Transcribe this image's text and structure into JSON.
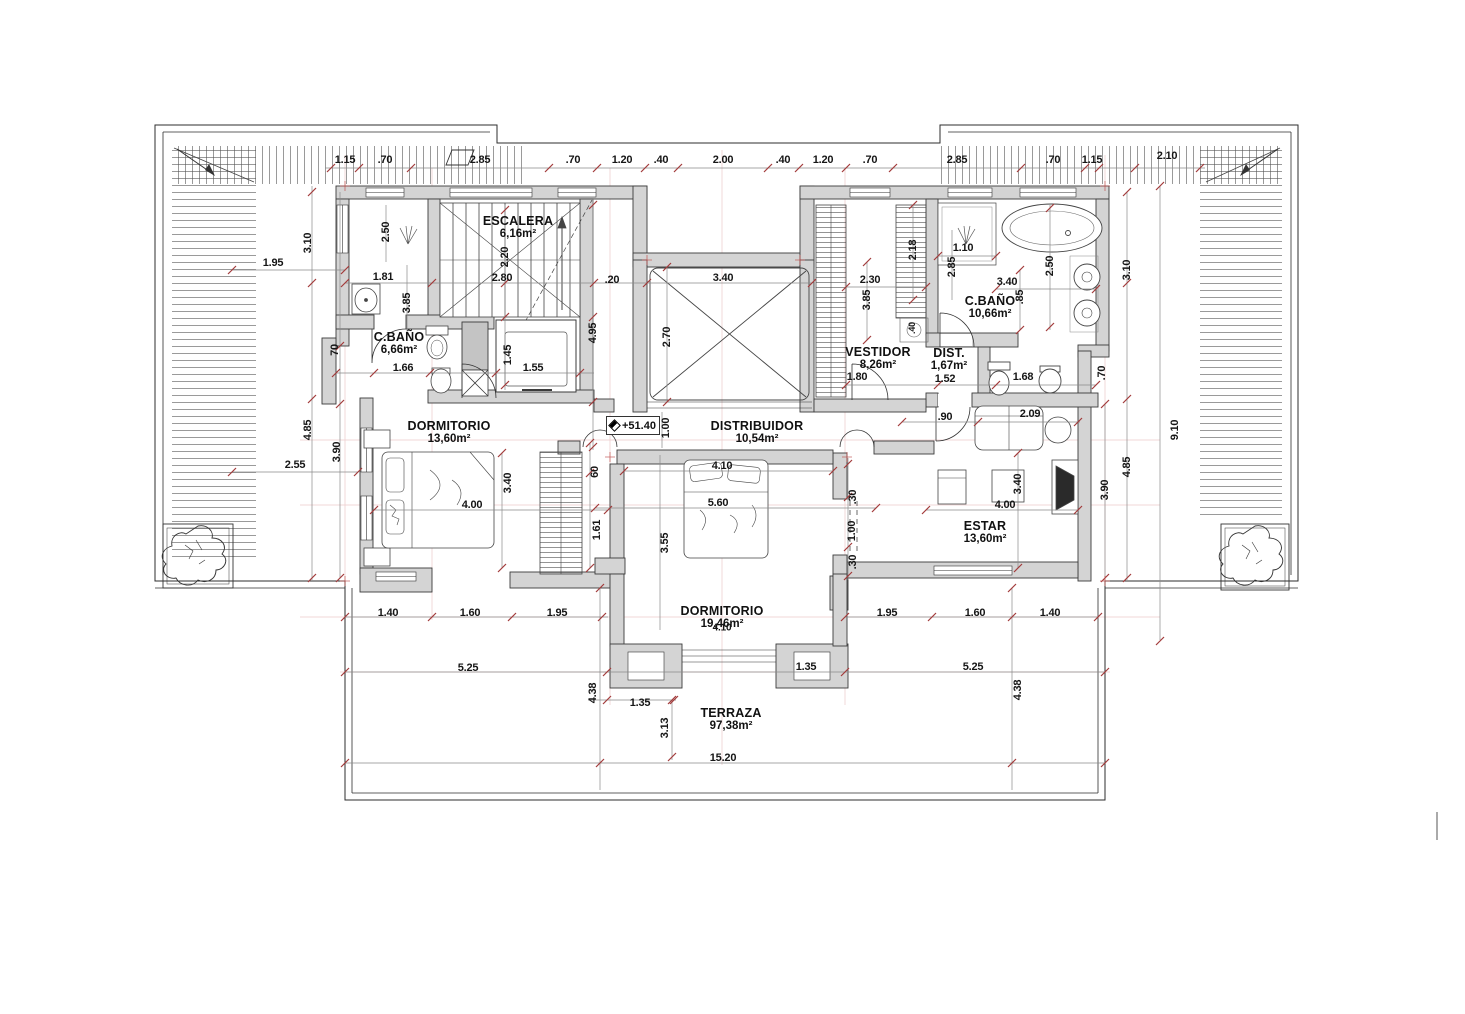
{
  "colors": {
    "wall_fill": "#d4d4d4",
    "wall_stroke": "#3b3b3b",
    "tick": "#a33b3b",
    "faint_line": "#e7bdbd"
  },
  "level": {
    "value": "+51.40"
  },
  "rooms": [
    {
      "name": "ESCALERA",
      "area": "6,16m²",
      "x": 518,
      "y": 228
    },
    {
      "name": "C.BAÑO",
      "area": "6,66m²",
      "x": 399,
      "y": 344
    },
    {
      "name": "DORMITORIO",
      "area": "13,60m²",
      "x": 449,
      "y": 433
    },
    {
      "name": "DISTRIBUIDOR",
      "area": "10,54m²",
      "x": 757,
      "y": 433
    },
    {
      "name": "DORMITORIO",
      "area": "19,46m²",
      "x": 722,
      "y": 618
    },
    {
      "name": "VESTIDOR",
      "area": "8,26m²",
      "x": 878,
      "y": 359
    },
    {
      "name": "DIST.",
      "area": "1,67m²",
      "x": 949,
      "y": 360
    },
    {
      "name": "C.BAÑO",
      "area": "10,66m²",
      "x": 990,
      "y": 308
    },
    {
      "name": "ESTAR",
      "area": "13,60m²",
      "x": 985,
      "y": 533
    },
    {
      "name": "TERRAZA",
      "area": "97,38m²",
      "x": 731,
      "y": 720
    }
  ],
  "dimensions": [
    {
      "t": "1.15",
      "x": 345,
      "y": 160
    },
    {
      "t": ".70",
      "x": 385,
      "y": 160
    },
    {
      "t": "2.85",
      "x": 480,
      "y": 160
    },
    {
      "t": ".70",
      "x": 573,
      "y": 160
    },
    {
      "t": "1.20",
      "x": 622,
      "y": 160
    },
    {
      "t": ".40",
      "x": 661,
      "y": 160
    },
    {
      "t": "2.00",
      "x": 723,
      "y": 160
    },
    {
      "t": ".40",
      "x": 783,
      "y": 160
    },
    {
      "t": "1.20",
      "x": 823,
      "y": 160
    },
    {
      "t": ".70",
      "x": 870,
      "y": 160
    },
    {
      "t": "2.85",
      "x": 957,
      "y": 160
    },
    {
      "t": ".70",
      "x": 1053,
      "y": 160
    },
    {
      "t": "1.15",
      "x": 1092,
      "y": 160
    },
    {
      "t": "2.10",
      "x": 1167,
      "y": 156
    },
    {
      "t": "1.95",
      "x": 273,
      "y": 263
    },
    {
      "t": "3.10",
      "x": 308,
      "y": 243,
      "r": 1
    },
    {
      "t": "2.50",
      "x": 386,
      "y": 232,
      "r": 1
    },
    {
      "t": "1.81",
      "x": 383,
      "y": 277
    },
    {
      "t": "3.85",
      "x": 407,
      "y": 303,
      "r": 1
    },
    {
      "t": "70",
      "x": 335,
      "y": 350,
      "r": 1
    },
    {
      "t": "4.85",
      "x": 308,
      "y": 430,
      "r": 1
    },
    {
      "t": "3.90",
      "x": 337,
      "y": 452,
      "r": 1
    },
    {
      "t": "2.55",
      "x": 295,
      "y": 465
    },
    {
      "t": "2.20",
      "x": 505,
      "y": 257,
      "r": 1
    },
    {
      "t": "2.80",
      "x": 502,
      "y": 278
    },
    {
      "t": ".20",
      "x": 612,
      "y": 280
    },
    {
      "t": "3.40",
      "x": 723,
      "y": 278
    },
    {
      "t": "2.70",
      "x": 667,
      "y": 337,
      "r": 1
    },
    {
      "t": "4.95",
      "x": 593,
      "y": 333,
      "r": 1
    },
    {
      "t": "1.45",
      "x": 508,
      "y": 355,
      "r": 1
    },
    {
      "t": "1.55",
      "x": 533,
      "y": 368
    },
    {
      "t": "1.66",
      "x": 403,
      "y": 368
    },
    {
      "t": "4.00",
      "x": 472,
      "y": 505
    },
    {
      "t": "3.40",
      "x": 508,
      "y": 483,
      "r": 1
    },
    {
      "t": "60",
      "x": 595,
      "y": 472,
      "r": 1
    },
    {
      "t": "1.61",
      "x": 597,
      "y": 530,
      "r": 1
    },
    {
      "t": "1.00",
      "x": 666,
      "y": 428,
      "r": 1
    },
    {
      "t": "4.10",
      "x": 722,
      "y": 466
    },
    {
      "t": "5.60",
      "x": 718,
      "y": 503
    },
    {
      "t": "3.55",
      "x": 665,
      "y": 543,
      "r": 1
    },
    {
      "t": ".30",
      "x": 853,
      "y": 497,
      "r": 1
    },
    {
      "t": "1.00",
      "x": 852,
      "y": 531,
      "r": 1
    },
    {
      "t": ".30",
      "x": 853,
      "y": 562,
      "r": 1
    },
    {
      "t": "4.10",
      "x": 722,
      "y": 628,
      "s": 10
    },
    {
      "t": "2.30",
      "x": 870,
      "y": 280
    },
    {
      "t": "3.85",
      "x": 867,
      "y": 300,
      "r": 1
    },
    {
      "t": "2.18",
      "x": 913,
      "y": 250,
      "r": 1
    },
    {
      "t": "1.10",
      "x": 963,
      "y": 248
    },
    {
      "t": "2.85",
      "x": 952,
      "y": 267,
      "r": 1
    },
    {
      "t": "3.40",
      "x": 1007,
      "y": 282
    },
    {
      "t": ".85",
      "x": 1020,
      "y": 297,
      "r": 1
    },
    {
      "t": "2.50",
      "x": 1050,
      "y": 266,
      "r": 1
    },
    {
      "t": "3.10",
      "x": 1127,
      "y": 270,
      "r": 1
    },
    {
      "t": ".40",
      "x": 913,
      "y": 328,
      "r": 1,
      "s": 9
    },
    {
      "t": "1.80",
      "x": 857,
      "y": 377
    },
    {
      "t": "1.52",
      "x": 945,
      "y": 379
    },
    {
      "t": "1.68",
      "x": 1023,
      "y": 377
    },
    {
      "t": ".70",
      "x": 1102,
      "y": 373,
      "r": 1
    },
    {
      "t": ".90",
      "x": 945,
      "y": 417
    },
    {
      "t": "2.09",
      "x": 1030,
      "y": 414
    },
    {
      "t": "4.00",
      "x": 1005,
      "y": 505
    },
    {
      "t": "3.40",
      "x": 1018,
      "y": 484,
      "r": 1
    },
    {
      "t": "3.90",
      "x": 1105,
      "y": 490,
      "r": 1
    },
    {
      "t": "4.85",
      "x": 1127,
      "y": 467,
      "r": 1
    },
    {
      "t": "9.10",
      "x": 1175,
      "y": 430,
      "r": 1
    },
    {
      "t": "1.40",
      "x": 388,
      "y": 613
    },
    {
      "t": "1.60",
      "x": 470,
      "y": 613
    },
    {
      "t": "1.95",
      "x": 557,
      "y": 613
    },
    {
      "t": "1.95",
      "x": 887,
      "y": 613
    },
    {
      "t": "1.60",
      "x": 975,
      "y": 613
    },
    {
      "t": "1.40",
      "x": 1050,
      "y": 613
    },
    {
      "t": "5.25",
      "x": 468,
      "y": 668
    },
    {
      "t": "5.25",
      "x": 973,
      "y": 667
    },
    {
      "t": "4.38",
      "x": 593,
      "y": 693,
      "r": 1
    },
    {
      "t": "4.38",
      "x": 1018,
      "y": 690,
      "r": 1
    },
    {
      "t": "1.35",
      "x": 640,
      "y": 703
    },
    {
      "t": "1.35",
      "x": 806,
      "y": 667
    },
    {
      "t": "3.13",
      "x": 665,
      "y": 728,
      "r": 1
    },
    {
      "t": "15.20",
      "x": 723,
      "y": 758
    }
  ]
}
